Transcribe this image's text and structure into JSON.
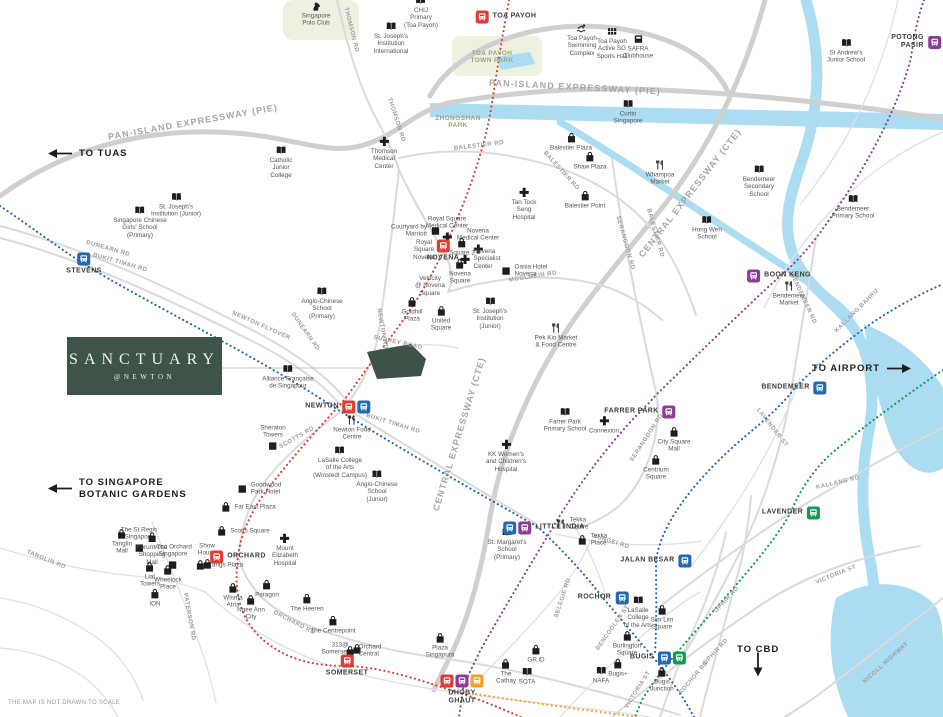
{
  "meta": {
    "disclaimer": "THE MAP IS NOT DRAWN TO SCALE"
  },
  "logo": {
    "title": "SANCTUARY",
    "subtitle": "@NEWTON",
    "bg": "#3f5449"
  },
  "legend_colors": {
    "ns": "#e23b32",
    "dt": "#2268b2",
    "ne": "#8e3d97",
    "ew": "#0f9d4d",
    "cc": "#f6a021"
  },
  "arrows": [
    {
      "label": "TO TUAS",
      "dir": "left",
      "x": 48,
      "y": 148
    },
    {
      "label": "TO SINGAPORE\nBOTANIC GARDENS",
      "dir": "left",
      "x": 48,
      "y": 477
    },
    {
      "label": "TO AIRPORT",
      "dir": "right",
      "x": 812,
      "y": 363
    },
    {
      "label": "TO CBD",
      "dir": "down",
      "x": 737,
      "y": 644
    }
  ],
  "park_labels": [
    {
      "text": "TOA PAYOH\nTOWN PARK",
      "x": 492,
      "y": 57
    },
    {
      "text": "ZHONGSHAN\nPARK",
      "x": 458,
      "y": 122
    }
  ],
  "road_labels": [
    {
      "text": "PAN-ISLAND EXPRESSWAY (PIE)",
      "x": 193,
      "y": 122,
      "rot": -10,
      "kind": "expressway"
    },
    {
      "text": "PAN-ISLAND EXPRESSWAY (PIE)",
      "x": 575,
      "y": 87,
      "rot": 3,
      "kind": "expressway"
    },
    {
      "text": "CENTRAL EXPRESSWAY (CTE)",
      "x": 690,
      "y": 193,
      "rot": -52,
      "kind": "expressway"
    },
    {
      "text": "CENTRAL EXPRESSWAY (CTE)",
      "x": 459,
      "y": 434,
      "rot": -73,
      "kind": "expressway"
    },
    {
      "text": "THOMSON RD",
      "x": 351,
      "y": 30,
      "rot": 76
    },
    {
      "text": "THOMSON RD",
      "x": 396,
      "y": 120,
      "rot": 72
    },
    {
      "text": "BALESTIER RD",
      "x": 479,
      "y": 146,
      "rot": -7
    },
    {
      "text": "BALESTIER RD",
      "x": 561,
      "y": 171,
      "rot": 48
    },
    {
      "text": "BALESTIER RD",
      "x": 655,
      "y": 233,
      "rot": 74
    },
    {
      "text": "DUNEARN RD",
      "x": 108,
      "y": 249,
      "rot": 16
    },
    {
      "text": "BUKIT TIMAH RD",
      "x": 120,
      "y": 263,
      "rot": 16
    },
    {
      "text": "NEWTON FLYOVER",
      "x": 261,
      "y": 326,
      "rot": 24
    },
    {
      "text": "DUNEARN RD",
      "x": 305,
      "y": 332,
      "rot": 55
    },
    {
      "text": "NEWTON RD",
      "x": 382,
      "y": 329,
      "rot": 80
    },
    {
      "text": "SURREY ROAD",
      "x": 398,
      "y": 343,
      "rot": 12
    },
    {
      "text": "MOULMEIN RD",
      "x": 533,
      "y": 277,
      "rot": -9
    },
    {
      "text": "SCOTTS RD",
      "x": 297,
      "y": 438,
      "rot": -30
    },
    {
      "text": "BUKIT TIMAH RD",
      "x": 393,
      "y": 424,
      "rot": 17
    },
    {
      "text": "SERANGOON RD",
      "x": 625,
      "y": 243,
      "rot": 74
    },
    {
      "text": "SERANGOON RD",
      "x": 647,
      "y": 438,
      "rot": -57
    },
    {
      "text": "BENDEMEER RD",
      "x": 803,
      "y": 299,
      "rot": 65
    },
    {
      "text": "KALLANG BAHRU",
      "x": 857,
      "y": 311,
      "rot": -45
    },
    {
      "text": "KALLANG RD",
      "x": 838,
      "y": 483,
      "rot": -13
    },
    {
      "text": "LAVENDER ST",
      "x": 772,
      "y": 428,
      "rot": 52
    },
    {
      "text": "VICTORIA ST",
      "x": 836,
      "y": 575,
      "rot": -22
    },
    {
      "text": "VICTORIA ST",
      "x": 638,
      "y": 690,
      "rot": -58
    },
    {
      "text": "OPHIR RD",
      "x": 727,
      "y": 600,
      "rot": -47
    },
    {
      "text": "OPHIR RD",
      "x": 716,
      "y": 652,
      "rot": -47
    },
    {
      "text": "ROCHOR RD",
      "x": 694,
      "y": 678,
      "rot": -50
    },
    {
      "text": "NICOLL HIGHWAY",
      "x": 886,
      "y": 663,
      "rot": -42
    },
    {
      "text": "SUNGEI RD",
      "x": 611,
      "y": 542,
      "rot": 17
    },
    {
      "text": "SELEGIE RD",
      "x": 563,
      "y": 598,
      "rot": -72
    },
    {
      "text": "BENCOOLEN ST",
      "x": 613,
      "y": 628,
      "rot": -55
    },
    {
      "text": "TANGLIN RD",
      "x": 46,
      "y": 560,
      "rot": 22
    },
    {
      "text": "PATERSON RD",
      "x": 189,
      "y": 617,
      "rot": 80
    },
    {
      "text": "ORCHARD RD",
      "x": 294,
      "y": 623,
      "rot": 27
    }
  ],
  "stations": [
    {
      "name": "TOA PAYOH",
      "lines": [
        "ns"
      ],
      "x": 506,
      "y": 17,
      "side": "right"
    },
    {
      "name": "POTONG PASIR",
      "lines": [
        "ne"
      ],
      "x": 916,
      "y": 42,
      "side": "left"
    },
    {
      "name": "STEVENS",
      "lines": [
        "dt"
      ],
      "x": 84,
      "y": 264,
      "side": "below"
    },
    {
      "name": "NOVENA",
      "lines": [
        "ns"
      ],
      "x": 443,
      "y": 251,
      "side": "below"
    },
    {
      "name": "BOON KENG",
      "lines": [
        "ne"
      ],
      "x": 779,
      "y": 276,
      "side": "right"
    },
    {
      "name": "BENDEMEER",
      "lines": [
        "dt"
      ],
      "x": 794,
      "y": 388,
      "side": "left"
    },
    {
      "name": "NEWTON",
      "lines": [
        "ns",
        "dt"
      ],
      "x": 338,
      "y": 407,
      "side": "left"
    },
    {
      "name": "FARRER PARK",
      "lines": [
        "ne"
      ],
      "x": 640,
      "y": 412,
      "side": "left"
    },
    {
      "name": "LITTLE INDIA",
      "lines": [
        "dt",
        "ne"
      ],
      "x": 544,
      "y": 528,
      "side": "right"
    },
    {
      "name": "LAVENDER",
      "lines": [
        "ew"
      ],
      "x": 791,
      "y": 513,
      "side": "left"
    },
    {
      "name": "JALAN BESAR",
      "lines": [
        "dt"
      ],
      "x": 656,
      "y": 561,
      "side": "left"
    },
    {
      "name": "ROCHOR",
      "lines": [
        "dt"
      ],
      "x": 603,
      "y": 598,
      "side": "left"
    },
    {
      "name": "ORCHARD",
      "lines": [
        "ns"
      ],
      "x": 238,
      "y": 557,
      "side": "right"
    },
    {
      "name": "SOMERSET",
      "lines": [
        "ns"
      ],
      "x": 347,
      "y": 666,
      "side": "below"
    },
    {
      "name": "DHOBY\nGHAUT",
      "lines": [
        "ns",
        "ne",
        "cc"
      ],
      "x": 462,
      "y": 690,
      "side": "below"
    },
    {
      "name": "BUGIS",
      "lines": [
        "dt",
        "ew"
      ],
      "x": 658,
      "y": 658,
      "side": "left"
    }
  ],
  "pois": [
    {
      "label": "Singapore\nPolo Club",
      "icon": "horse",
      "x": 316,
      "y": 14
    },
    {
      "label": "CHIJ\nPrimary\n(Toa Payoh)",
      "icon": "school",
      "x": 421,
      "y": 12
    },
    {
      "label": "St. Joseph's\nInstitution\nInternational",
      "icon": "school",
      "x": 391,
      "y": 38
    },
    {
      "label": "Toa Payoh\nSwimming\nComplex",
      "icon": "swim",
      "x": 582,
      "y": 40
    },
    {
      "label": "Toa Payoh\nActive SG\nSports Hall",
      "icon": "sports",
      "x": 612,
      "y": 43
    },
    {
      "label": "SAFRA\nClubhouse",
      "icon": "club",
      "x": 638,
      "y": 47
    },
    {
      "label": "St Andrew's\nJunior School",
      "icon": "school",
      "x": 846,
      "y": 51
    },
    {
      "label": "Curtin\nSingapore",
      "icon": "school",
      "x": 628,
      "y": 112
    },
    {
      "label": "Catholic\nJunior\nCollege",
      "icon": "school",
      "x": 281,
      "y": 162
    },
    {
      "label": "Thomson\nMedical\nCenter",
      "icon": "hospital",
      "x": 384,
      "y": 153
    },
    {
      "label": "Balestier Plaza",
      "icon": "mall",
      "x": 571,
      "y": 142
    },
    {
      "label": "Shaw Plaza",
      "icon": "mall",
      "x": 590,
      "y": 161
    },
    {
      "label": "Whampoa\nMarket",
      "icon": "food",
      "x": 660,
      "y": 173
    },
    {
      "label": "Balestier Point",
      "icon": "mall",
      "x": 585,
      "y": 200
    },
    {
      "label": "Bendemeer\nSecondary\nSchool",
      "icon": "school",
      "x": 759,
      "y": 181
    },
    {
      "label": "Bendemeer\nPrimary School",
      "icon": "school",
      "x": 853,
      "y": 207
    },
    {
      "label": "Hong Wen\nSchool",
      "icon": "school",
      "x": 707,
      "y": 228
    },
    {
      "label": "St. Joseph's\nInstitution (Junior)",
      "icon": "school",
      "x": 176,
      "y": 205
    },
    {
      "label": "Singapore Chinese\nGirls' School\n(Primary)",
      "icon": "school",
      "x": 140,
      "y": 222
    },
    {
      "label": "Royal Square\nMedical Center",
      "icon": "hospital",
      "x": 447,
      "y": 229,
      "side": "above"
    },
    {
      "label": "Courtyard by\nMarriott",
      "icon": "hotel",
      "x": 416,
      "y": 231,
      "side": "left"
    },
    {
      "label": "Royal\nSquare\nNovena",
      "icon": "none",
      "x": 424,
      "y": 250
    },
    {
      "label": "Novena\nMedical Center",
      "icon": "hospital",
      "x": 478,
      "y": 241,
      "side": "above"
    },
    {
      "label": "Tan Tock\nSeng\nHospital",
      "icon": "hospital",
      "x": 524,
      "y": 204
    },
    {
      "label": "Novena\nSpecialist\nCenter",
      "icon": "hospital",
      "x": 480,
      "y": 259,
      "side": "right"
    },
    {
      "label": "Square 2",
      "icon": "mall",
      "x": 462,
      "y": 247
    },
    {
      "label": "Oasia Hotel\nNovena",
      "icon": "hotel",
      "x": 524,
      "y": 271,
      "side": "right"
    },
    {
      "label": "Novena\nSquare",
      "icon": "mall",
      "x": 460,
      "y": 272
    },
    {
      "label": "Velocity\n@ Novena\nSquare",
      "icon": "none",
      "x": 430,
      "y": 286
    },
    {
      "label": "Goldhill\nPlaza",
      "icon": "mall",
      "x": 412,
      "y": 310
    },
    {
      "label": "United\nSquare",
      "icon": "mall",
      "x": 441,
      "y": 319
    },
    {
      "label": "St. Joseph's\nInstitution\n(Junior)",
      "icon": "school",
      "x": 490,
      "y": 313
    },
    {
      "label": "Pek Kio Market\n& Food Centre",
      "icon": "food",
      "x": 556,
      "y": 336
    },
    {
      "label": "Anglo-Chinese\nSchool\n(Primary)",
      "icon": "school",
      "x": 322,
      "y": 303
    },
    {
      "label": "Alliance Française\nde Singapour",
      "icon": "school",
      "x": 288,
      "y": 377
    },
    {
      "label": "Sheraton\nTowers",
      "icon": "hotel",
      "x": 273,
      "y": 438,
      "side": "above"
    },
    {
      "label": "Newton Food\nCentre",
      "icon": "food",
      "x": 352,
      "y": 428
    },
    {
      "label": "LaSalle College\nof the Arts\n(Winstedt Campus)",
      "icon": "school",
      "x": 340,
      "y": 462
    },
    {
      "label": "Anglo-Chinese\nSchool\n(Junior)",
      "icon": "school",
      "x": 377,
      "y": 486
    },
    {
      "label": "Farrer Park\nPrimary School",
      "icon": "school",
      "x": 565,
      "y": 420
    },
    {
      "label": "Connexion",
      "icon": "hospital",
      "x": 604,
      "y": 425
    },
    {
      "label": "KK Women's\nand Children's\nHospital",
      "icon": "hospital",
      "x": 506,
      "y": 456
    },
    {
      "label": "City Square\nMall",
      "icon": "mall",
      "x": 674,
      "y": 440
    },
    {
      "label": "Centrium\nSquare",
      "icon": "mall",
      "x": 656,
      "y": 468
    },
    {
      "label": "Goodwood\nPark Hotel",
      "icon": "hotel",
      "x": 259,
      "y": 489,
      "side": "right"
    },
    {
      "label": "Far East Plaza",
      "icon": "mall",
      "x": 248,
      "y": 507,
      "side": "right"
    },
    {
      "label": "Scotts Square",
      "icon": "mall",
      "x": 243,
      "y": 531,
      "side": "right"
    },
    {
      "label": "The St Regis\nSingapore",
      "icon": "hotel",
      "x": 139,
      "y": 540,
      "side": "above"
    },
    {
      "label": "Tanglin\nMall",
      "icon": "mall",
      "x": 122,
      "y": 542
    },
    {
      "label": "voco Orchard\nSingapore",
      "icon": "hotel",
      "x": 173,
      "y": 557,
      "side": "above"
    },
    {
      "label": "Show\nHouse",
      "icon": "mall",
      "x": 207,
      "y": 556,
      "side": "above"
    },
    {
      "label": "Forum The\nShopping\nMall",
      "icon": "mall",
      "x": 152,
      "y": 549
    },
    {
      "label": "Tangs Plaza",
      "icon": "mall",
      "x": 219,
      "y": 565,
      "side": "right"
    },
    {
      "label": "Mount\nElizabeth\nHospital",
      "icon": "hospital",
      "x": 285,
      "y": 550
    },
    {
      "label": "Liat\nTowers",
      "icon": "mall",
      "x": 150,
      "y": 575
    },
    {
      "label": "Wheelock\nPlace",
      "icon": "mall",
      "x": 168,
      "y": 578
    },
    {
      "label": "ION",
      "icon": "mall",
      "x": 155,
      "y": 598
    },
    {
      "label": "Wisma\nAtria",
      "icon": "mall",
      "x": 233,
      "y": 596
    },
    {
      "label": "Paragon",
      "icon": "mall",
      "x": 267,
      "y": 589
    },
    {
      "label": "Ngee Ann\nCity",
      "icon": "mall",
      "x": 251,
      "y": 608
    },
    {
      "label": "The Heeren",
      "icon": "mall",
      "x": 307,
      "y": 603
    },
    {
      "label": "The Centrepoint",
      "icon": "mall",
      "x": 333,
      "y": 625
    },
    {
      "label": "313@\nSomerset",
      "icon": "mall",
      "x": 342,
      "y": 649,
      "side": "left"
    },
    {
      "label": "Orchard\nCentral",
      "icon": "mall",
      "x": 363,
      "y": 651,
      "side": "right"
    },
    {
      "label": "Plaza\nSingapura",
      "icon": "mall",
      "x": 440,
      "y": 646
    },
    {
      "label": "The\nCathay",
      "icon": "mall",
      "x": 506,
      "y": 672
    },
    {
      "label": "SOTA",
      "icon": "school",
      "x": 527,
      "y": 676
    },
    {
      "label": "GR.iD",
      "icon": "mall",
      "x": 536,
      "y": 654
    },
    {
      "label": "Burlington\nSquare",
      "icon": "mall",
      "x": 627,
      "y": 644
    },
    {
      "label": "Sim Lim\nSquare",
      "icon": "mall",
      "x": 662,
      "y": 618
    },
    {
      "label": "LaSalle\nCollege\nof the Arts",
      "icon": "school",
      "x": 638,
      "y": 612
    },
    {
      "label": "NAFA",
      "icon": "school",
      "x": 601,
      "y": 675
    },
    {
      "label": "Bugis+",
      "icon": "mall",
      "x": 618,
      "y": 668
    },
    {
      "label": "Bugis\nJunction",
      "icon": "mall",
      "x": 662,
      "y": 680
    },
    {
      "label": "Tekka\nCentre",
      "icon": "food",
      "x": 572,
      "y": 524,
      "side": "right"
    },
    {
      "label": "Tekka\nPlace",
      "icon": "mall",
      "x": 592,
      "y": 540,
      "side": "right"
    },
    {
      "label": "Bendemeer\nMarket",
      "icon": "food",
      "x": 789,
      "y": 294
    },
    {
      "label": "St. Margaret's\nSchool\n(Primary)",
      "icon": "school",
      "x": 507,
      "y": 544
    }
  ]
}
